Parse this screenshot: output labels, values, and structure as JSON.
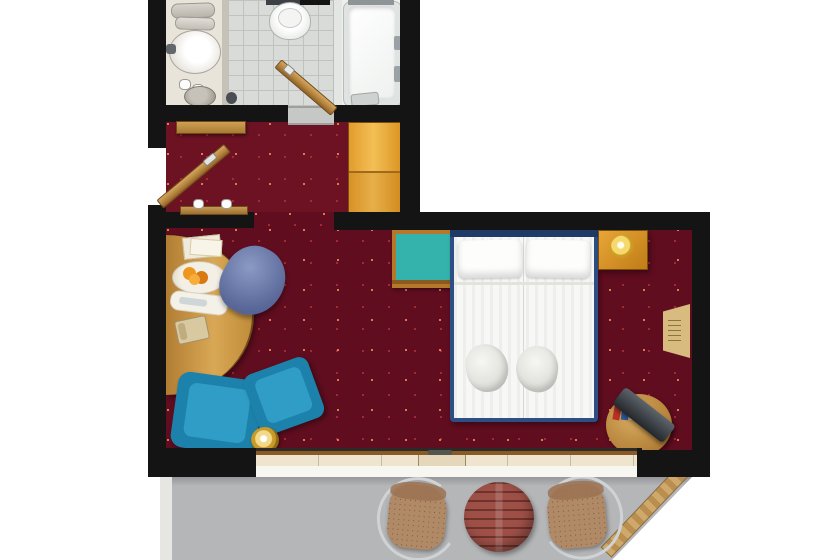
{
  "meta": {
    "title": "Hotel room floor plan (top-down)"
  },
  "colors": {
    "wall": "#141414",
    "carpet": "#5f0d1f",
    "carpet_hall": "#6d1222",
    "tile": "#d9dbd8",
    "tile_line": "#bfc3c0",
    "wardrobe": "#e8a637",
    "bed_frame": "#2e4f86",
    "bedding": "#f7f7f5",
    "teal": "#33b3ab",
    "armchair": "#1d82ab",
    "armchair_light": "#2f9dc6",
    "desk_chair": "#5b6a9a",
    "balcony_floor": "#b5b6b8",
    "balcony_table": "#9e5047",
    "wicker": "#b08966",
    "chrome": "#cfd3d5",
    "gold": "#d9a820",
    "window_glass": "#efe5cf"
  },
  "rooms": {
    "bathroom": "Bathroom",
    "hallway": "Entry hallway",
    "bedroom": "Bedroom and sitting area",
    "balcony": "Balcony"
  },
  "furniture": {
    "vanity_towels": "Rolled towels",
    "sink": "Washbasin",
    "glasses": "Glasses",
    "bin": "Waste bin",
    "toilet": "Toilet",
    "toilet_brush": "Toilet brush",
    "bathroom_door": "Bathroom door, open",
    "bathtub": "Bathtub",
    "bath_mat": "Bath step",
    "entry_door": "Entrance door, open",
    "door_handle": "Door handle",
    "console_shelf": "Console shelf",
    "wardrobe": "Wardrobe",
    "bench": "Luggage bench with slippers",
    "desk": "Curved writing desk",
    "papers": "Papers",
    "fruit_bowl": "Fruit bowl",
    "tray": "Welcome tray",
    "telephone": "Telephone",
    "desk_chair": "Upholstered desk chair",
    "armchair_left": "Blue armchair",
    "armchair_right": "Blue armchair",
    "floor_lamp": "Brass floor lamp",
    "luggage_rack": "Luggage rack with teal top",
    "double_bed": "Double bed with two pillows",
    "pillow_left": "Pillow",
    "pillow_right": "Pillow",
    "bed_towel_left": "Folded bathrobe",
    "bed_towel_right": "Folded bathrobe",
    "nightstand": "Bedside table with brass lamp",
    "tv_table": "Round table with television and minibar items",
    "wall_rack": "Wall-mounted magazine rack",
    "window": "Window front",
    "balcony_door_handle": "Balcony door handle",
    "balcony_chair_left": "Rattan chair",
    "balcony_chair_right": "Rattan chair",
    "balcony_table": "Round slatted balcony table",
    "railing": "Diagonal balcony divider"
  }
}
